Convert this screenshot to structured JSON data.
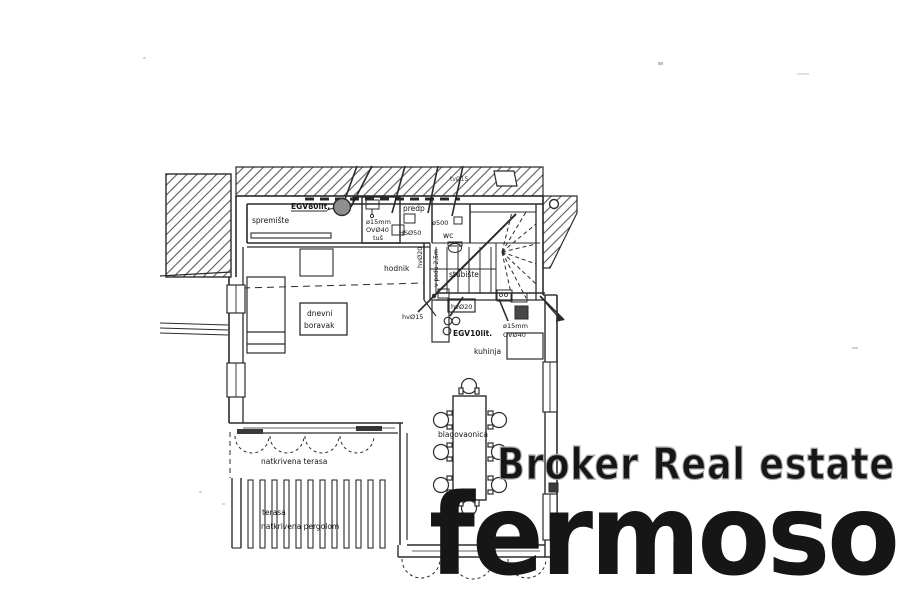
{
  "watermarks": {
    "broker": "Broker Real estate",
    "brand": "fermoso"
  },
  "colors": {
    "brand_red": "#c23a28",
    "watermark_outline": "#a8a8a8"
  },
  "plan": {
    "rooms": {
      "spremiste": "spremište",
      "predsoblje": "predp",
      "wc": "wc",
      "hodnik": "hodnik",
      "stubiste": "stubište",
      "kuhinja": "kuhinja",
      "dnevni_line1": "dnevni",
      "dnevni_line2": "boravak",
      "blagovaonica": "blagovaonica",
      "natkrivena_terasa": "natkrivena terasa",
      "terasa": "terasa",
      "natkrivena_pergolom": "natkrivena pergolom"
    },
    "annotations": {
      "egv80": "EGV80lit.",
      "egv10": "EGV10lit.",
      "shower_pipe": "ø15mm",
      "shower_drain": "OVØ40",
      "shower": "tuš",
      "hs50": "HSØ50",
      "o500": "ø500",
      "tv15": "tvØ15",
      "hv20_vertical": "hvØ20",
      "v_podu": "v podu 2,5m",
      "hv20_box": "hvØ20",
      "hv15": "hvØ15",
      "kitchen_pipe": "ø15mm",
      "kitchen_drain": "OVØ40"
    }
  }
}
